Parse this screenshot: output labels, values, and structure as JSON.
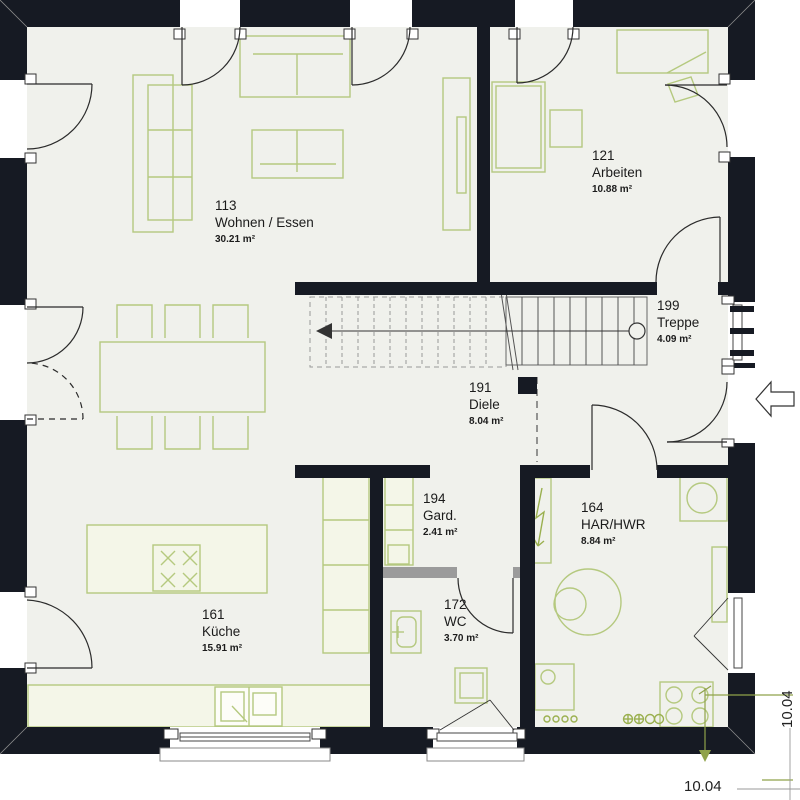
{
  "rooms": [
    {
      "number": "113",
      "name": "Wohnen / Essen",
      "area": "30.21 m²"
    },
    {
      "number": "121",
      "name": "Arbeiten",
      "area": "10.88 m²"
    },
    {
      "number": "199",
      "name": "Treppe",
      "area": "4.09 m²"
    },
    {
      "number": "191",
      "name": "Diele",
      "area": "8.04 m²"
    },
    {
      "number": "194",
      "name": "Gard.",
      "area": "2.41 m²"
    },
    {
      "number": "164",
      "name": "HAR/HWR",
      "area": "8.84 m²"
    },
    {
      "number": "172",
      "name": "WC",
      "area": "3.70 m²"
    },
    {
      "number": "161",
      "name": "Küche",
      "area": "15.91 m²"
    }
  ],
  "dimensions": {
    "bottom": "10.04",
    "right": "10.04"
  },
  "icons": {
    "entrance_arrow": "arrow-pointing-left-into-house",
    "stair_direction_arrow": "arrow-at-stair-start",
    "hob_burners": "x-cross-burners"
  },
  "colors": {
    "wall": "#161a23",
    "floor": "#f0f1ec",
    "furniture_line": "#b5c97f",
    "counter_fill": "#f4f6e8",
    "dimension_line": "#8fa24a",
    "lightweight_wall": "#9b9b9b"
  }
}
